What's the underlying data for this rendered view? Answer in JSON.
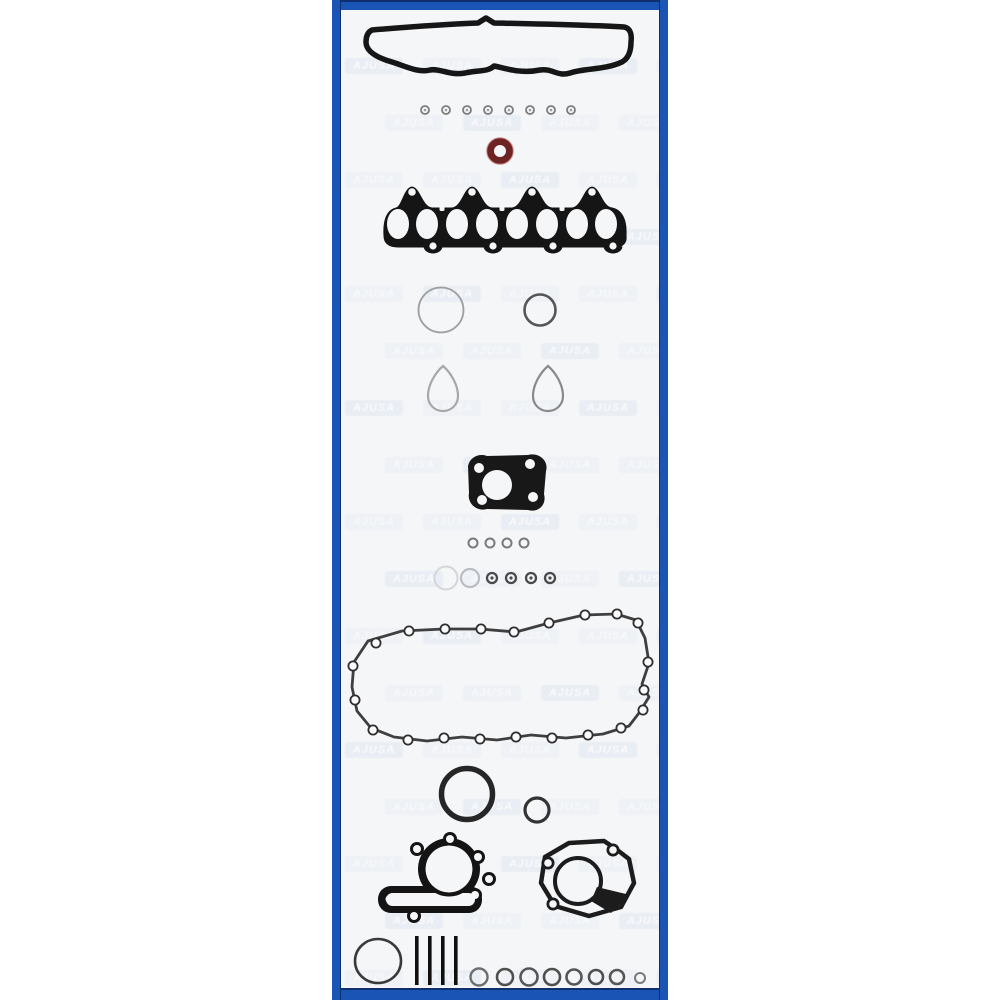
{
  "page": {
    "background": "#ffffff"
  },
  "panel": {
    "border": {
      "blue": "#1a54b5",
      "navy": "#0d2f6e"
    },
    "inner_background": "#f5f6f8"
  },
  "watermark": {
    "text": "AJUSA",
    "tile_color": "#c6d2e6",
    "text_color": "#ffffff"
  },
  "illustration": {
    "description": "Full engine gasket set line-art montage",
    "ink_color": "#1a1a1a",
    "o_ring_color": "#6f2424",
    "parts": [
      {
        "name": "valve-cover-gasket"
      },
      {
        "name": "valve-stem-seals",
        "count": 8
      },
      {
        "name": "o-ring",
        "color": "#6f2424"
      },
      {
        "name": "manifold-gasket",
        "ports": 8
      },
      {
        "name": "round-gasket-large"
      },
      {
        "name": "round-gasket-small"
      },
      {
        "name": "camshaft-seals",
        "count": 2
      },
      {
        "name": "exhaust-flange-gasket"
      },
      {
        "name": "washers",
        "count": 4
      },
      {
        "name": "grommets",
        "count": 6
      },
      {
        "name": "oil-pan-gasket",
        "bolt_holes": 21
      },
      {
        "name": "crankshaft-seal"
      },
      {
        "name": "auxiliary-seal"
      },
      {
        "name": "water-pump-gaskets",
        "count": 2
      },
      {
        "name": "front-seal"
      },
      {
        "name": "cylinder-head-bolts",
        "count": 4
      },
      {
        "name": "seal-rings",
        "count": 8
      }
    ]
  }
}
